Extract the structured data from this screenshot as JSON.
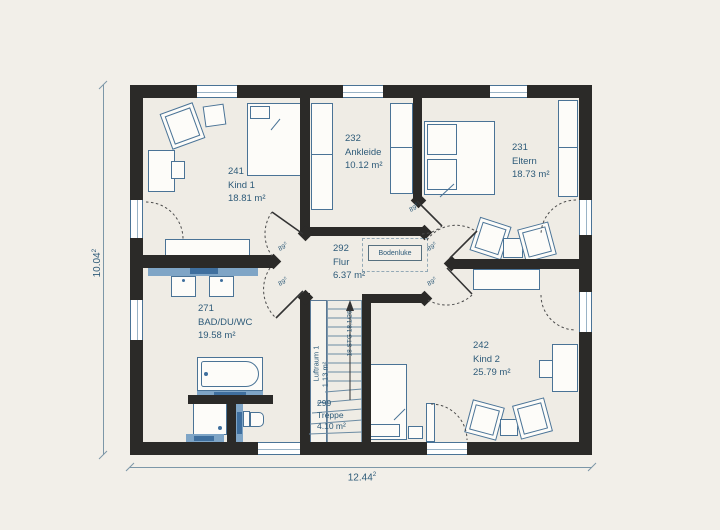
{
  "plan_title": "floor-plan-upper-floor",
  "colors": {
    "wall": "#2b2a28",
    "furniture_line": "#4a7396",
    "sanitary_fill": "#7fa5c6",
    "sanitary_label": "#3f6f9e",
    "text": "#2e5b79",
    "background": "#f2efe9",
    "room_fill": "#efece5"
  },
  "rooms": [
    {
      "number": "241",
      "name": "Kind 1",
      "area": "18.81 m²"
    },
    {
      "number": "232",
      "name": "Ankleide",
      "area": "10.12 m²"
    },
    {
      "number": "231",
      "name": "Eltern",
      "area": "18.73 m²"
    },
    {
      "number": "292",
      "name": "Flur",
      "area": "6.37 m²"
    },
    {
      "number": "271",
      "name": "BAD/DU/WC",
      "area": "19.58 m²"
    },
    {
      "number": "242",
      "name": "Kind 2",
      "area": "25.79 m²"
    },
    {
      "number": "299",
      "name": "Treppe",
      "area": "4.10 m²"
    }
  ],
  "annotations": {
    "bodenluke": "Bodenluke",
    "luftraum": {
      "name": "Luftraum 1",
      "area": "1.13 m²"
    },
    "stair_note": "18 STG 18,1/26",
    "door_width": {
      "value": "89",
      "sup": "5"
    }
  },
  "dimensions": {
    "left": {
      "value": "10.04",
      "sup": "2"
    },
    "bottom": {
      "value": "12.44",
      "sup": "2"
    }
  }
}
